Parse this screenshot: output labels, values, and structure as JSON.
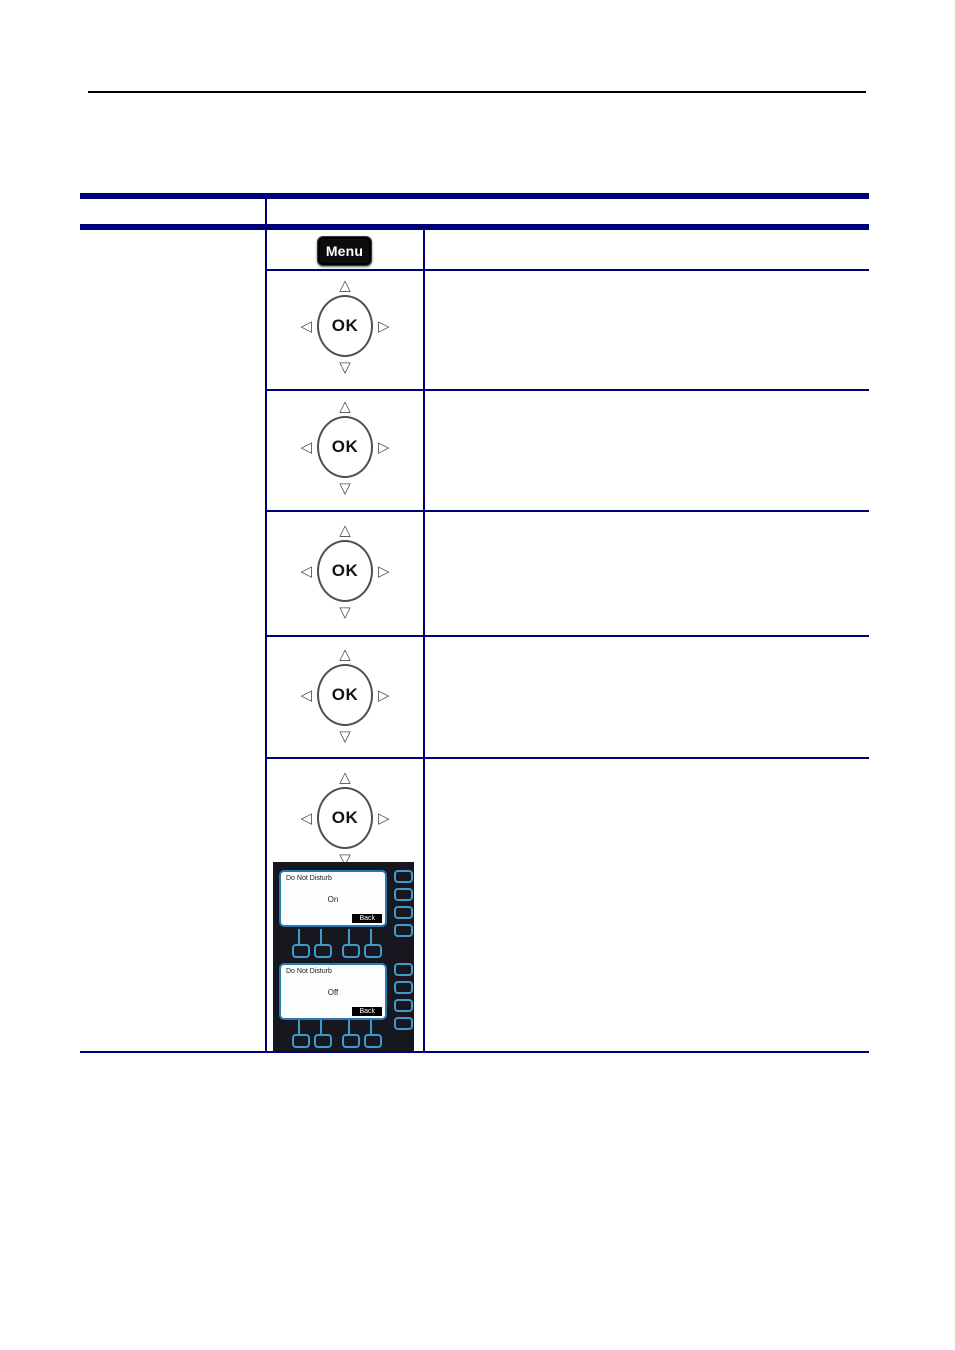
{
  "controls": {
    "menu_button_label": "Menu",
    "ok_button_label": "OK",
    "nav_arrows": {
      "up": "△",
      "down": "▽",
      "left": "◁",
      "right": "▷"
    }
  },
  "lcd_screens": [
    {
      "title": "Do Not Disturb",
      "value": "On",
      "back_label": "Back"
    },
    {
      "title": "Do Not Disturb",
      "value": "Off",
      "back_label": "Back"
    }
  ],
  "colors": {
    "table_border_navy": "#000078",
    "page_rule_black": "#000000",
    "lcd_outline_blue": "#3e9bd0",
    "lcd_screen_border_blue": "#2878b4",
    "lcd_panel_background": "#17171f",
    "menu_button_background": "#0d0d0d"
  }
}
